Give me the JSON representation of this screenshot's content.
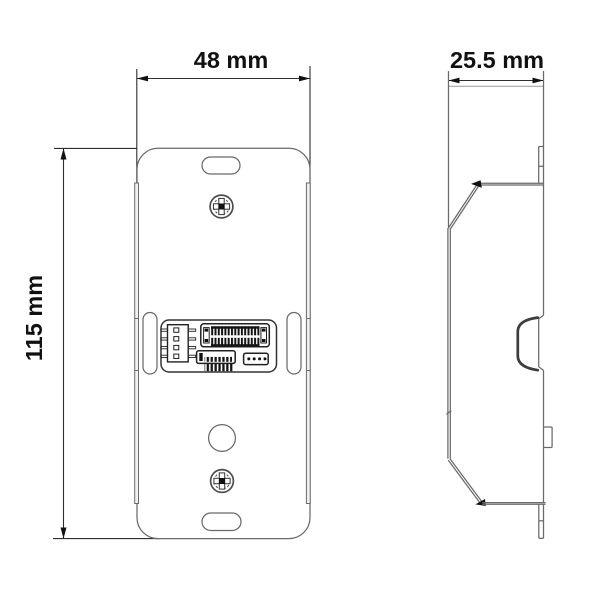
{
  "drawing": {
    "type": "technical-dimension-drawing",
    "views": {
      "front": {
        "width_label": "48 mm",
        "height_label": "115 mm",
        "features": [
          "top-mounting-slot",
          "top-screw",
          "left-slot",
          "right-slot",
          "wiring-connector-panel",
          "cable-hole",
          "bottom-screw",
          "bottom-mounting-slot"
        ]
      },
      "side": {
        "depth_label": "25.5 mm",
        "features": [
          "spring-clip",
          "side-latch-tab",
          "folded-bracket-profile"
        ]
      }
    }
  },
  "colors": {
    "background": "#ffffff",
    "outline": "#6a6a6a",
    "detail": "#1f1f1f",
    "dimension_line": "#2e2e2e",
    "text": "#111111"
  }
}
